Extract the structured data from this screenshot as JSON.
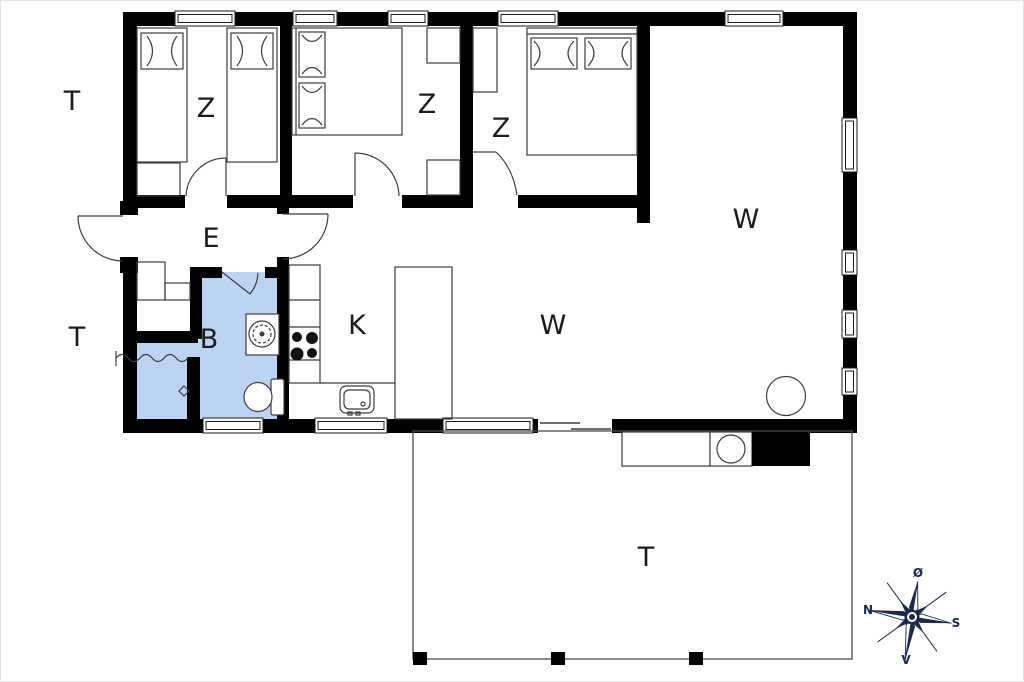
{
  "plan": {
    "colors": {
      "wall": "#000000",
      "bathroom_fill": "#bdd3f4",
      "furniture_line": "#3c3c3c",
      "compass": "#1c2b4d",
      "page_border": "#e3e3e3",
      "background": "#ffffff"
    },
    "rooms": [
      {
        "id": "terrace-top",
        "label": "T"
      },
      {
        "id": "bedroom-1",
        "label": "Z"
      },
      {
        "id": "bedroom-2",
        "label": "Z"
      },
      {
        "id": "bedroom-3",
        "label": "Z"
      },
      {
        "id": "living-room",
        "label": "W"
      },
      {
        "id": "entrance",
        "label": "E"
      },
      {
        "id": "terrace-left",
        "label": "T"
      },
      {
        "id": "bathroom",
        "label": "B"
      },
      {
        "id": "kitchen",
        "label": "K"
      },
      {
        "id": "living-room-2",
        "label": "W"
      },
      {
        "id": "terrace-bottom",
        "label": "T"
      }
    ],
    "compass": {
      "north": "N",
      "south": "S",
      "east": "Ø",
      "west": "V"
    },
    "fixtures": [
      "single-bed",
      "single-bed",
      "double-bed",
      "double-bed",
      "wardrobe",
      "wardrobe",
      "wardrobe",
      "wardrobe",
      "closet-shelf",
      "shower",
      "floor-drain",
      "washbasin",
      "toilet",
      "kitchen-counter",
      "stove",
      "kitchen-sink",
      "kitchen-island",
      "dining-table",
      "outdoor-kitchen",
      "terrace",
      "compass-rose"
    ]
  }
}
